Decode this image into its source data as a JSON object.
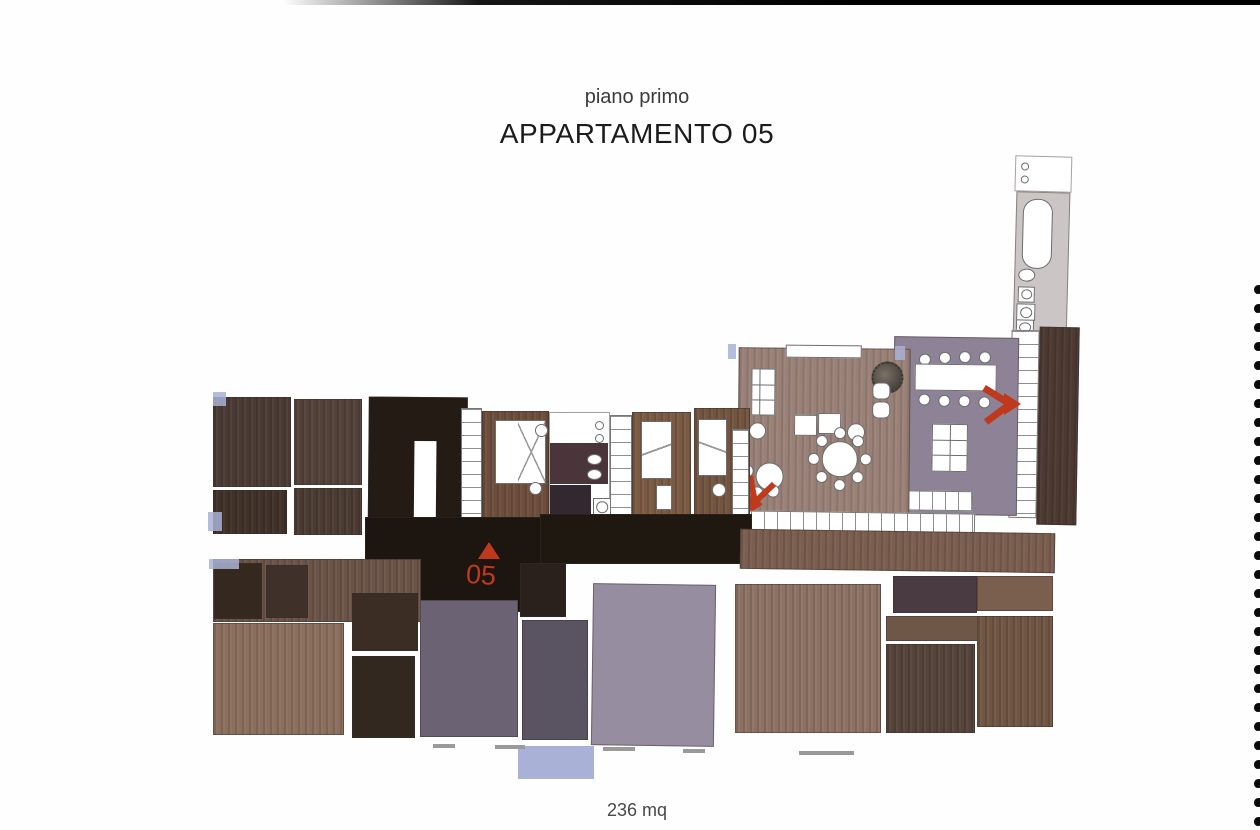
{
  "page": {
    "subtitle": "piano primo",
    "title": "APPARTAMENTO 05",
    "area_label": "236 mq"
  },
  "plan": {
    "unit_label": "05"
  },
  "colors": {
    "accent_red": "#bf3a1c",
    "wood_living": "#9a8177",
    "wood_dark": "#4a3a32",
    "wood_mid": "#7b5a43",
    "corridor_black": "#1c1510",
    "dining_purple": "#8d8296",
    "mauve_room": "#968da0",
    "lavender_window": "#a9b1d6",
    "bath_gray": "#ccc5c5"
  },
  "binding": {
    "dot_count": 29,
    "dot_start_y": 285,
    "dot_spacing": 19
  }
}
